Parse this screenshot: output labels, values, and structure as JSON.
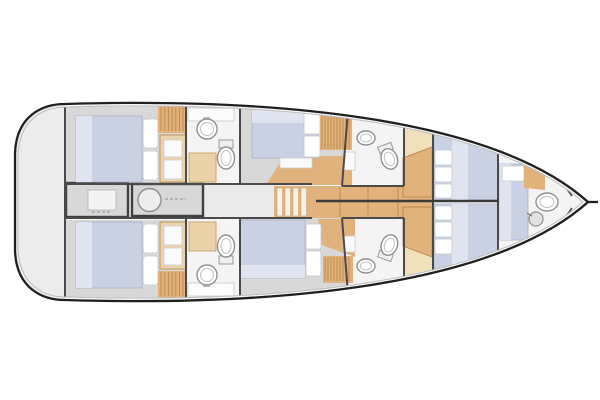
{
  "diagram": {
    "type": "yacht-interior-floor-plan",
    "view": "top-down",
    "bow_direction": "right",
    "rooms": [
      {
        "id": "swim-platform",
        "label": "Swim platform",
        "fixtures": []
      },
      {
        "id": "aft-cabin-port",
        "label": "Aft cabin (port)",
        "fixtures": [
          "double-bed",
          "pillows",
          "hanging-wardrobe",
          "cabinet"
        ]
      },
      {
        "id": "aft-cabin-starboard",
        "label": "Aft cabin (starboard)",
        "fixtures": [
          "double-bed",
          "pillows",
          "hanging-wardrobe",
          "cabinet"
        ]
      },
      {
        "id": "aft-head-port",
        "label": "Aft head (port)",
        "fixtures": [
          "sink",
          "toilet",
          "shower"
        ]
      },
      {
        "id": "aft-head-starboard",
        "label": "Aft head (starboard)",
        "fixtures": [
          "sink",
          "toilet",
          "shower"
        ]
      },
      {
        "id": "central-corridor",
        "label": "Central corridor / galley",
        "fixtures": [
          "counter-unit",
          "sink-counter-unit",
          "companionway-steps"
        ]
      },
      {
        "id": "mid-cabin-port",
        "label": "Mid cabin (port)",
        "fixtures": [
          "double-bed",
          "pillows",
          "louvered-wardrobe",
          "nightstand"
        ]
      },
      {
        "id": "mid-cabin-starboard",
        "label": "Mid cabin (starboard)",
        "fixtures": [
          "double-bed",
          "pillows",
          "louvered-wardrobe"
        ]
      },
      {
        "id": "forward-head-port",
        "label": "Forward head (port)",
        "fixtures": [
          "washbasin",
          "toilet"
        ]
      },
      {
        "id": "forward-head-starboard",
        "label": "Forward head (starboard)",
        "fixtures": [
          "washbasin",
          "toilet"
        ]
      },
      {
        "id": "forward-cabin-port",
        "label": "Forward cabin (port)",
        "fixtures": [
          "double-bed",
          "pillows",
          "desk",
          "lockers"
        ]
      },
      {
        "id": "forward-cabin-starboard",
        "label": "Forward cabin (starboard)",
        "fixtures": [
          "double-bed",
          "pillows",
          "desk",
          "lockers"
        ]
      },
      {
        "id": "bow-cabin",
        "label": "Bow crew cabin with head",
        "fixtures": [
          "berth",
          "pillow",
          "shelf",
          "toilet",
          "washbasin"
        ]
      }
    ],
    "fixture_counts": {
      "beds": 7,
      "toilets": 5,
      "sinks": 5,
      "showers": 2,
      "wardrobes": 4,
      "companionway_steps": 1,
      "corridor_counters": 2,
      "desks": 2
    }
  },
  "colors": {
    "hull-line": "#1f1f1f",
    "deck-line": "#bdbdbd",
    "wall": "#4a4a4a",
    "bulkhead": "#3a3a3a",
    "base-fill": "#f7f7f7",
    "platform": "#ececec",
    "floor-cabin": "#d8d8d8",
    "floor-corridor": "#eaeaea",
    "floor-head": "#f4f4f4",
    "wood": "#e2b27c",
    "wood-light": "#f2e0bd",
    "wood-stripe": "#bf8c4d",
    "cabinet": "#ecd3ab",
    "mattress": "#cbd1e4",
    "mattress-light": "#e0e4f0",
    "pillow": "#ffffff",
    "counter": "#d8d8d8",
    "counter-border": "#3f3f3f",
    "fixture": "#8f8f8f",
    "shower": "#ecd2a9"
  }
}
